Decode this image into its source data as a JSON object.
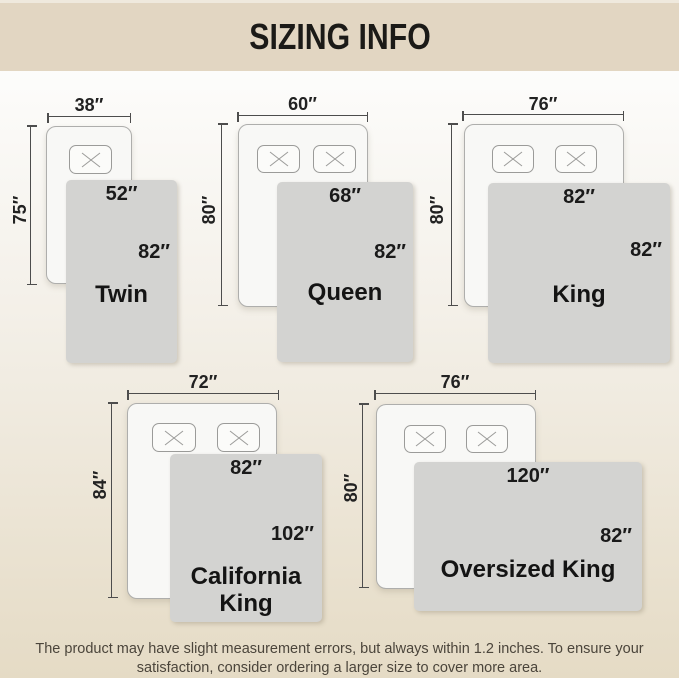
{
  "header": {
    "title": "SIZING INFO"
  },
  "sizes": [
    {
      "name": "Twin",
      "bed_width": "38″",
      "bed_length": "75″",
      "blanket_width": "52″",
      "blanket_length": "82″",
      "pillows": 1
    },
    {
      "name": "Queen",
      "bed_width": "60″",
      "bed_length": "80″",
      "blanket_width": "68″",
      "blanket_length": "82″",
      "pillows": 2
    },
    {
      "name": "King",
      "bed_width": "76″",
      "bed_length": "80″",
      "blanket_width": "82″",
      "blanket_length": "82″",
      "pillows": 2
    },
    {
      "name": "California King",
      "bed_width": "72″",
      "bed_length": "84″",
      "blanket_width": "82″",
      "blanket_length": "102″",
      "pillows": 2
    },
    {
      "name": "Oversized King",
      "bed_width": "76″",
      "bed_length": "80″",
      "blanket_width": "120″",
      "blanket_length": "82″",
      "pillows": 2
    }
  ],
  "footer": {
    "line1": "The product may have slight measurement errors, but always within 1.2 inches. To ensure your",
    "line2": "satisfaction, consider ordering a larger size to cover more area."
  },
  "colors": {
    "header_bg": "#e2d6c2",
    "background_top": "#fdfdfc",
    "background_bottom": "#e5dbc5",
    "blanket_gray": "#d3d3d1",
    "bed_fill": "#f8f8f6",
    "dimension_line": "#4d4d4d",
    "text_dark": "#1a1a1a"
  }
}
